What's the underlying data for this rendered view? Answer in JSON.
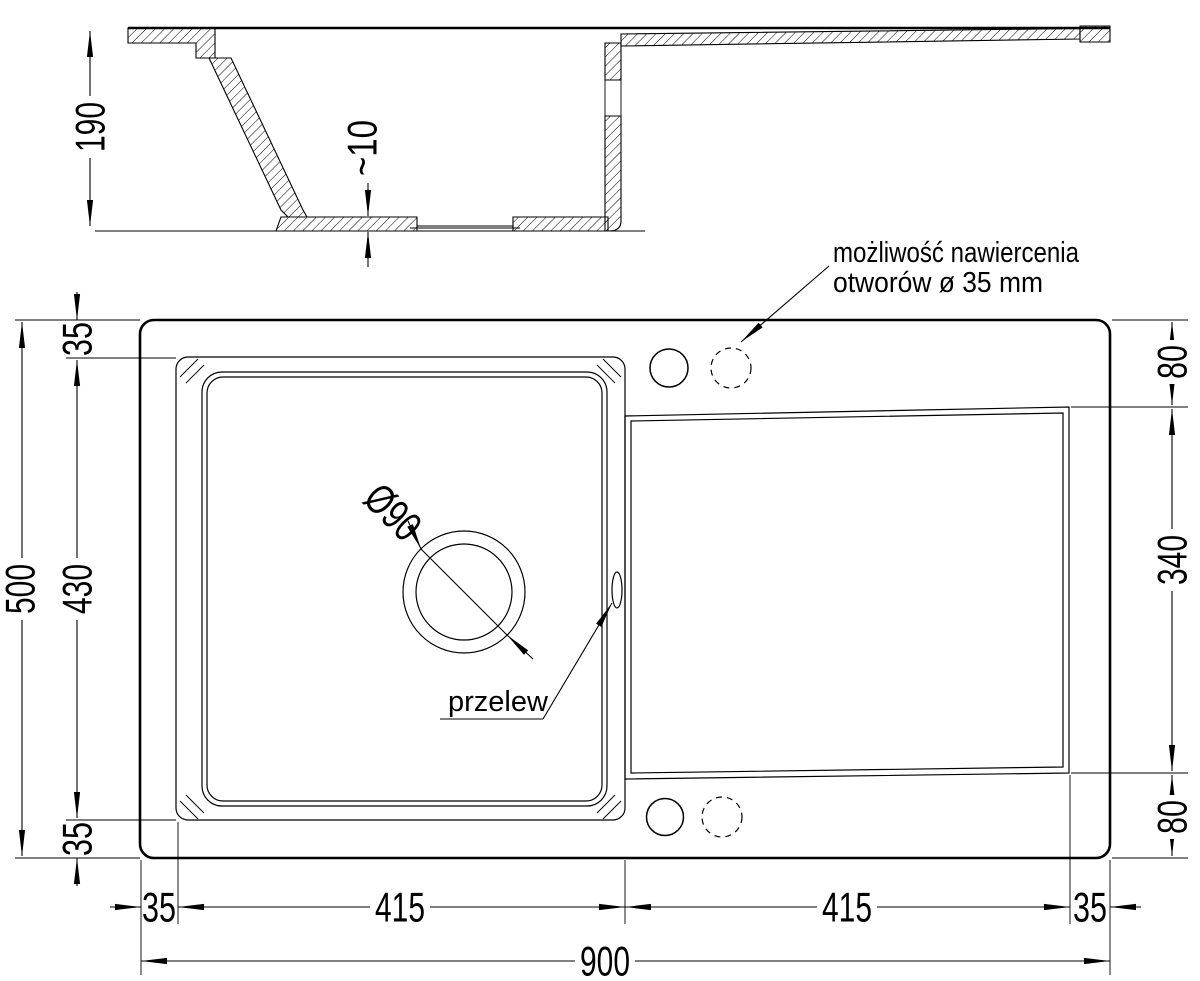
{
  "drawing": {
    "type": "technical-drawing",
    "subject": "kitchen sink with drainer - dimensioned views",
    "colors": {
      "line": "#000000",
      "background": "#ffffff"
    }
  },
  "section_view": {
    "depth_label": "190",
    "bottom_thickness_label": "~10"
  },
  "plan_view": {
    "drain_label": "Ø90",
    "overflow_label": "przelew",
    "drill_note": {
      "line1": "możliwość nawiercenia",
      "line2": "otworów ø 35 mm"
    }
  },
  "dims": {
    "total_height": "500",
    "bowl_height": "430",
    "left_margin_top": "35",
    "left_margin_bottom": "35",
    "right_margin_top": "80",
    "drainer_height": "340",
    "right_margin_bottom": "80",
    "bottom_margin_left": "35",
    "bowl_width": "415",
    "drainer_width": "415",
    "bottom_margin_right": "35",
    "total_width": "900"
  }
}
